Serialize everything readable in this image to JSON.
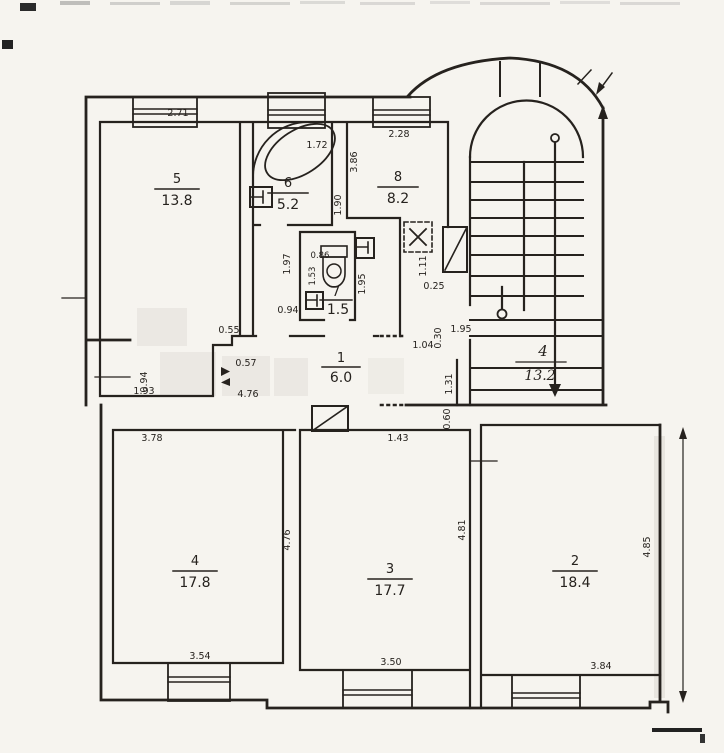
{
  "colors": {
    "ink": "#26221e",
    "paper": "#f6f4ef",
    "watermark": "#ebe8e3"
  },
  "rooms": {
    "r1": {
      "number": "1",
      "area": "6.0"
    },
    "r2": {
      "number": "2",
      "area": "18.4"
    },
    "r3": {
      "number": "3",
      "area": "17.7"
    },
    "r4": {
      "number": "4",
      "area": "17.8"
    },
    "r5": {
      "number": "5",
      "area": "13.8"
    },
    "r6": {
      "number": "6",
      "area": "5.2"
    },
    "r7": {
      "number": "7",
      "area": "1.5"
    },
    "r8": {
      "number": "8",
      "area": "8.2"
    },
    "stair": {
      "number": "4",
      "area": "13.2"
    }
  },
  "dims": {
    "r5_top": "2.71",
    "r5_bottom": "1.93",
    "r6_tub": "1.72",
    "r6_right": "1.90",
    "r8_top": "2.28",
    "r8_left": "3.86",
    "wc_outer_left": "1.97",
    "wc_top": "0.86",
    "wc_left": "1.53",
    "wc_right": "1.95",
    "wc_door": "0.94",
    "step_top": "0.55",
    "niche": "0.57",
    "niche_left": "0.94",
    "hall_width": "4.76",
    "door_w": "1.04",
    "door_jamb": "0.30",
    "landing_door": "1.95",
    "shaft_h": "0.25",
    "duct_h": "1.11",
    "landing_right": "1.31",
    "gap": "0.60",
    "hatch_w": "1.43",
    "r4_top": "3.78",
    "r4_right": "4.76",
    "r4_bottom": "3.54",
    "r3_bottom": "3.50",
    "r3_right": "4.81",
    "r2_bottom": "3.84",
    "r2_right": "4.85"
  }
}
